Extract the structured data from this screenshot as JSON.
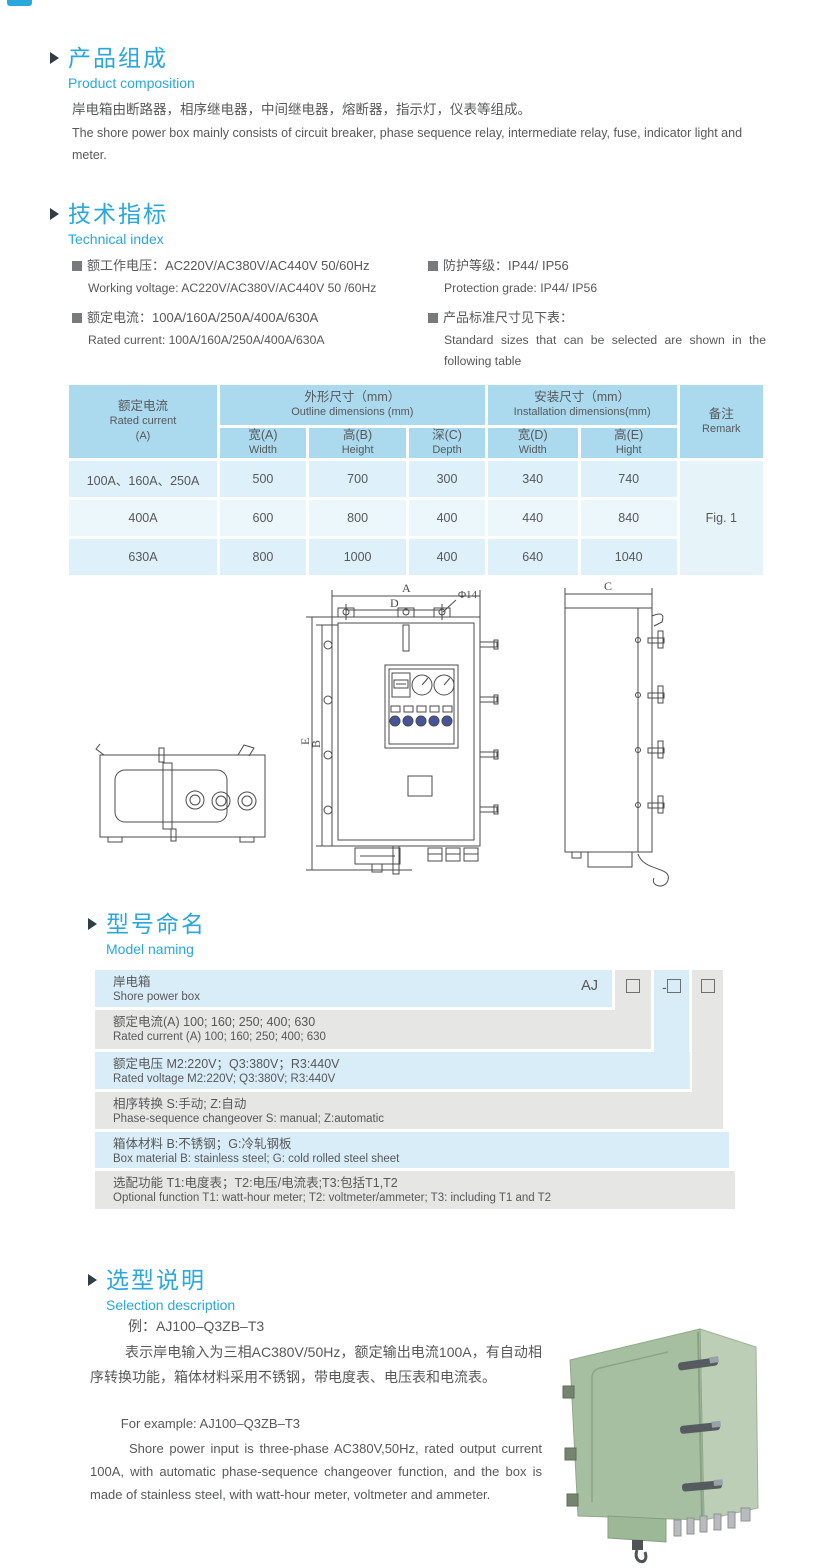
{
  "accent_color": "#2aa7dc",
  "text_color": "#57585a",
  "product": {
    "title_zh": "产品组成",
    "title_en": "Product  composition",
    "body_zh": "岸电箱由断路器，相序继电器，中间继电器，熔断器，指示灯，仪表等组成。",
    "body_en": "The shore power box mainly consists of circuit breaker, phase sequence relay, intermediate relay, fuse, indicator light and meter."
  },
  "tech": {
    "title_zh": "技术指标",
    "title_en": "Technical index",
    "specs": [
      {
        "zh": "额工作电压：AC220V/AC380V/AC440V  50/60Hz",
        "en": "Working voltage: AC220V/AC380V/AC440V 50 /60Hz"
      },
      {
        "zh": "额定电流：100A/160A/250A/400A/630A",
        "en": "Rated current: 100A/160A/250A/400A/630A"
      },
      {
        "zh": "防护等级：IP44/ IP56",
        "en": "Protection grade: IP44/ IP56"
      },
      {
        "zh": "产品标准尺寸见下表：",
        "en": "Standard sizes that can be selected are shown in the following table"
      }
    ]
  },
  "dim_table": {
    "col_current_zh": "额定电流",
    "col_current_en": "Rated current",
    "col_current_unit": "(A)",
    "outline_zh": "外形尺寸（mm）",
    "outline_en": "Outline dimensions (mm)",
    "install_zh": "安装尺寸（mm）",
    "install_en": "Installation dimensions(mm)",
    "remark_zh": "备注",
    "remark_en": "Remark",
    "sub": [
      {
        "zh": "宽(A)",
        "en": "Width"
      },
      {
        "zh": "高(B)",
        "en": "Height"
      },
      {
        "zh": "深(C)",
        "en": "Depth"
      },
      {
        "zh": "宽(D)",
        "en": "Width"
      },
      {
        "zh": "高(E)",
        "en": "Hight"
      }
    ],
    "rows": [
      {
        "current": "100A、160A、250A",
        "w": "500",
        "h": "700",
        "d": "300",
        "iw": "340",
        "ih": "740"
      },
      {
        "current": "400A",
        "w": "600",
        "h": "800",
        "d": "400",
        "iw": "440",
        "ih": "840"
      },
      {
        "current": "630A",
        "w": "800",
        "h": "1000",
        "d": "400",
        "iw": "640",
        "ih": "1040"
      }
    ],
    "remark_value": "Fig. 1"
  },
  "drawing": {
    "labels": {
      "a": "A",
      "d": "D",
      "phi": "Φ14",
      "b": "B",
      "e": "E",
      "c": "C"
    }
  },
  "naming": {
    "title_zh": "型号命名",
    "title_en": "Model naming",
    "code": {
      "prefix": "AJ",
      "box2_prefix": "-"
    },
    "rows": [
      {
        "zh": "岸电箱",
        "en": "Shore power box"
      },
      {
        "zh": "额定电流(A)  100; 160; 250; 400; 630",
        "en": "Rated current (A) 100; 160; 250; 400; 630"
      },
      {
        "zh": "额定电压   M2:220V；Q3:380V；R3:440V",
        "en": "Rated voltage  M2:220V;  Q3:380V;  R3:440V"
      },
      {
        "zh": "相序转换  S:手动; Z:自动",
        "en": "Phase-sequence changeover  S: manual;  Z:automatic"
      },
      {
        "zh": "箱体材料     B:不锈钢；G:冷轧钢板",
        "en": "Box material    B: stainless steel; G: cold rolled steel sheet"
      },
      {
        "zh": "选配功能       T1:电度表；T2:电压/电流表;T3:包括T1,T2",
        "en": "Optional function  T1: watt-hour meter; T2: voltmeter/ammeter; T3: including T1 and T2"
      }
    ]
  },
  "selection": {
    "title_zh": "选型说明",
    "title_en": "Selection description",
    "example_zh": "例：AJ100–Q3ZB–T3",
    "body_zh": "表示岸电输入为三相AC380V/50Hz，额定输出电流100A，有自动相序转换功能，箱体材料采用不锈钢，带电度表、电压表和电流表。",
    "example_en": "For example: AJ100–Q3ZB–T3",
    "body_en": "Shore power input is three-phase AC380V,50Hz, rated output current 100A, with automatic phase-sequence changeover function, and the box is made of stainless steel, with watt-hour meter, voltmeter and ammeter."
  }
}
